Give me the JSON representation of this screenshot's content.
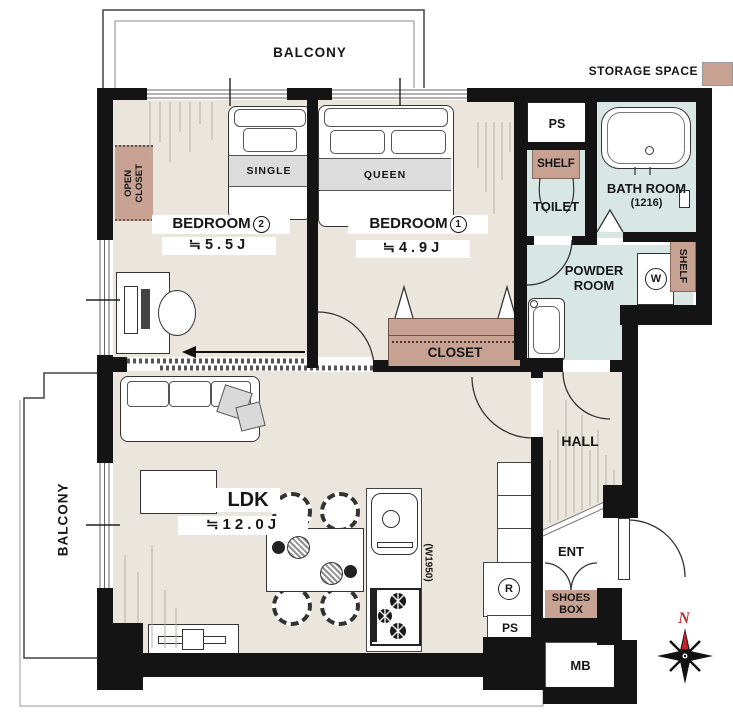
{
  "balcony": {
    "top": "BALCONY",
    "left": "BALCONY"
  },
  "legend": {
    "storage_label": "STORAGE SPACE"
  },
  "rooms": {
    "bedroom2": {
      "name": "BEDROOM",
      "number": "2",
      "size": "≒5.5J",
      "bed": "SINGLE"
    },
    "bedroom1": {
      "name": "BEDROOM",
      "number": "1",
      "size": "≒4.9J",
      "bed": "QUEEN"
    },
    "ldk": {
      "name": "LDK",
      "size": "≒12.0J"
    },
    "hall": {
      "name": "HALL"
    },
    "toilet": {
      "name": "TOILET"
    },
    "bathroom": {
      "name": "BATH ROOM",
      "size": "(1216)"
    },
    "powder": {
      "line1": "POWDER",
      "line2": "ROOM"
    },
    "entrance": {
      "name": "ENT"
    }
  },
  "storage": {
    "open_closet_line1": "OPEN",
    "open_closet_line2": "CLOSET",
    "closet": "CLOSET",
    "shelf_toilet": "SHELF",
    "shelf_powder": "SHELF",
    "shoes_line1": "SHOES",
    "shoes_line2": "BOX"
  },
  "utility": {
    "ps_top": "PS",
    "ps_bottom": "PS",
    "mb": "MB",
    "fridge": "R",
    "washer": "W",
    "kitchen_width": "(W1950)"
  },
  "compass": {
    "north": "N"
  },
  "colors": {
    "wall": "#141414",
    "floor": "#ebe6dd",
    "wet_floor": "#d9e7e4",
    "storage_brown": "#c7a192",
    "north_red": "#c0272d"
  }
}
